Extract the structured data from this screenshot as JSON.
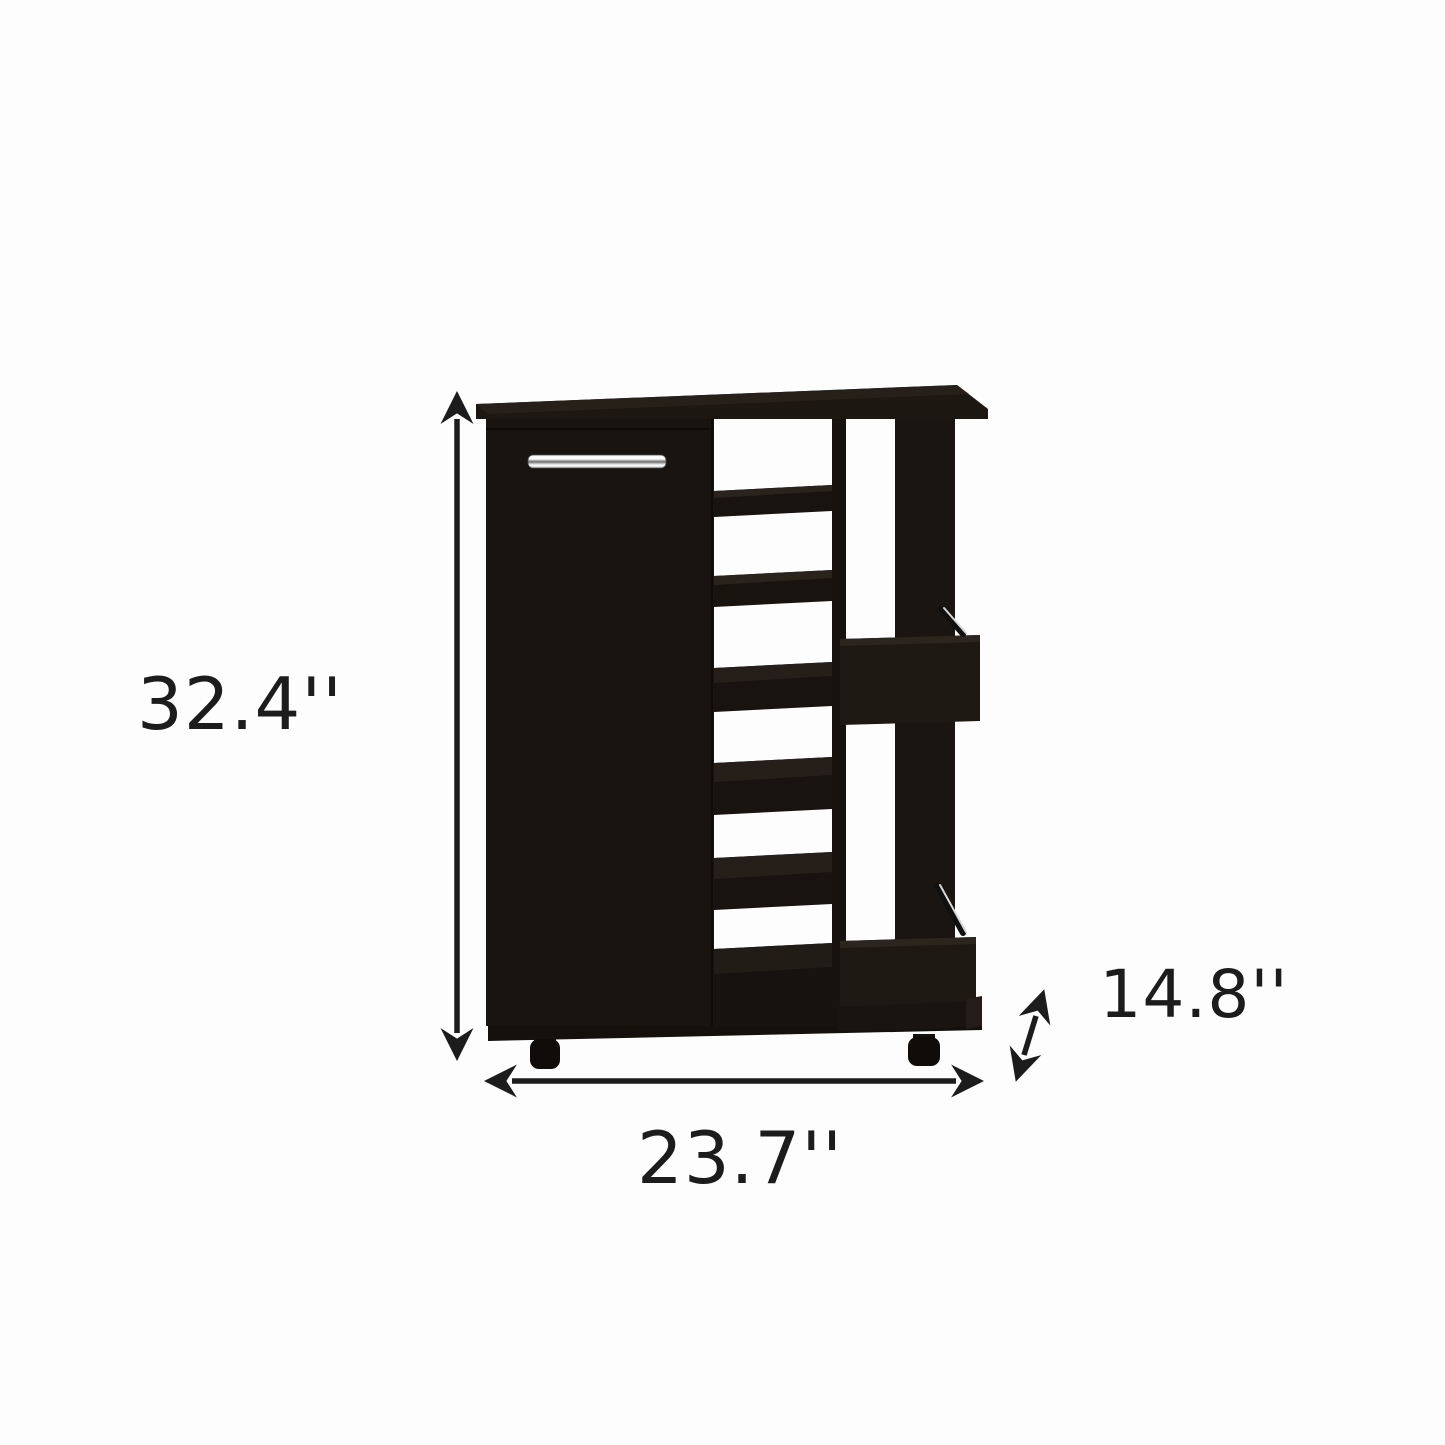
{
  "image": {
    "description": "Product dimension illustration of a black bar cart cabinet with a single door, open side shelving, two exterior bottle ledges with chrome rails, and caster wheels",
    "background_color": "#fdfdfd",
    "cabinet_color": "#1b1511",
    "handle_color": "#d9d9d9",
    "rail_highlight_color": "#d8d8d8",
    "annotation_color": "#1c1c1c"
  },
  "dimensions": {
    "height": "32.4''",
    "width": "23.7''",
    "depth": "14.8''"
  }
}
